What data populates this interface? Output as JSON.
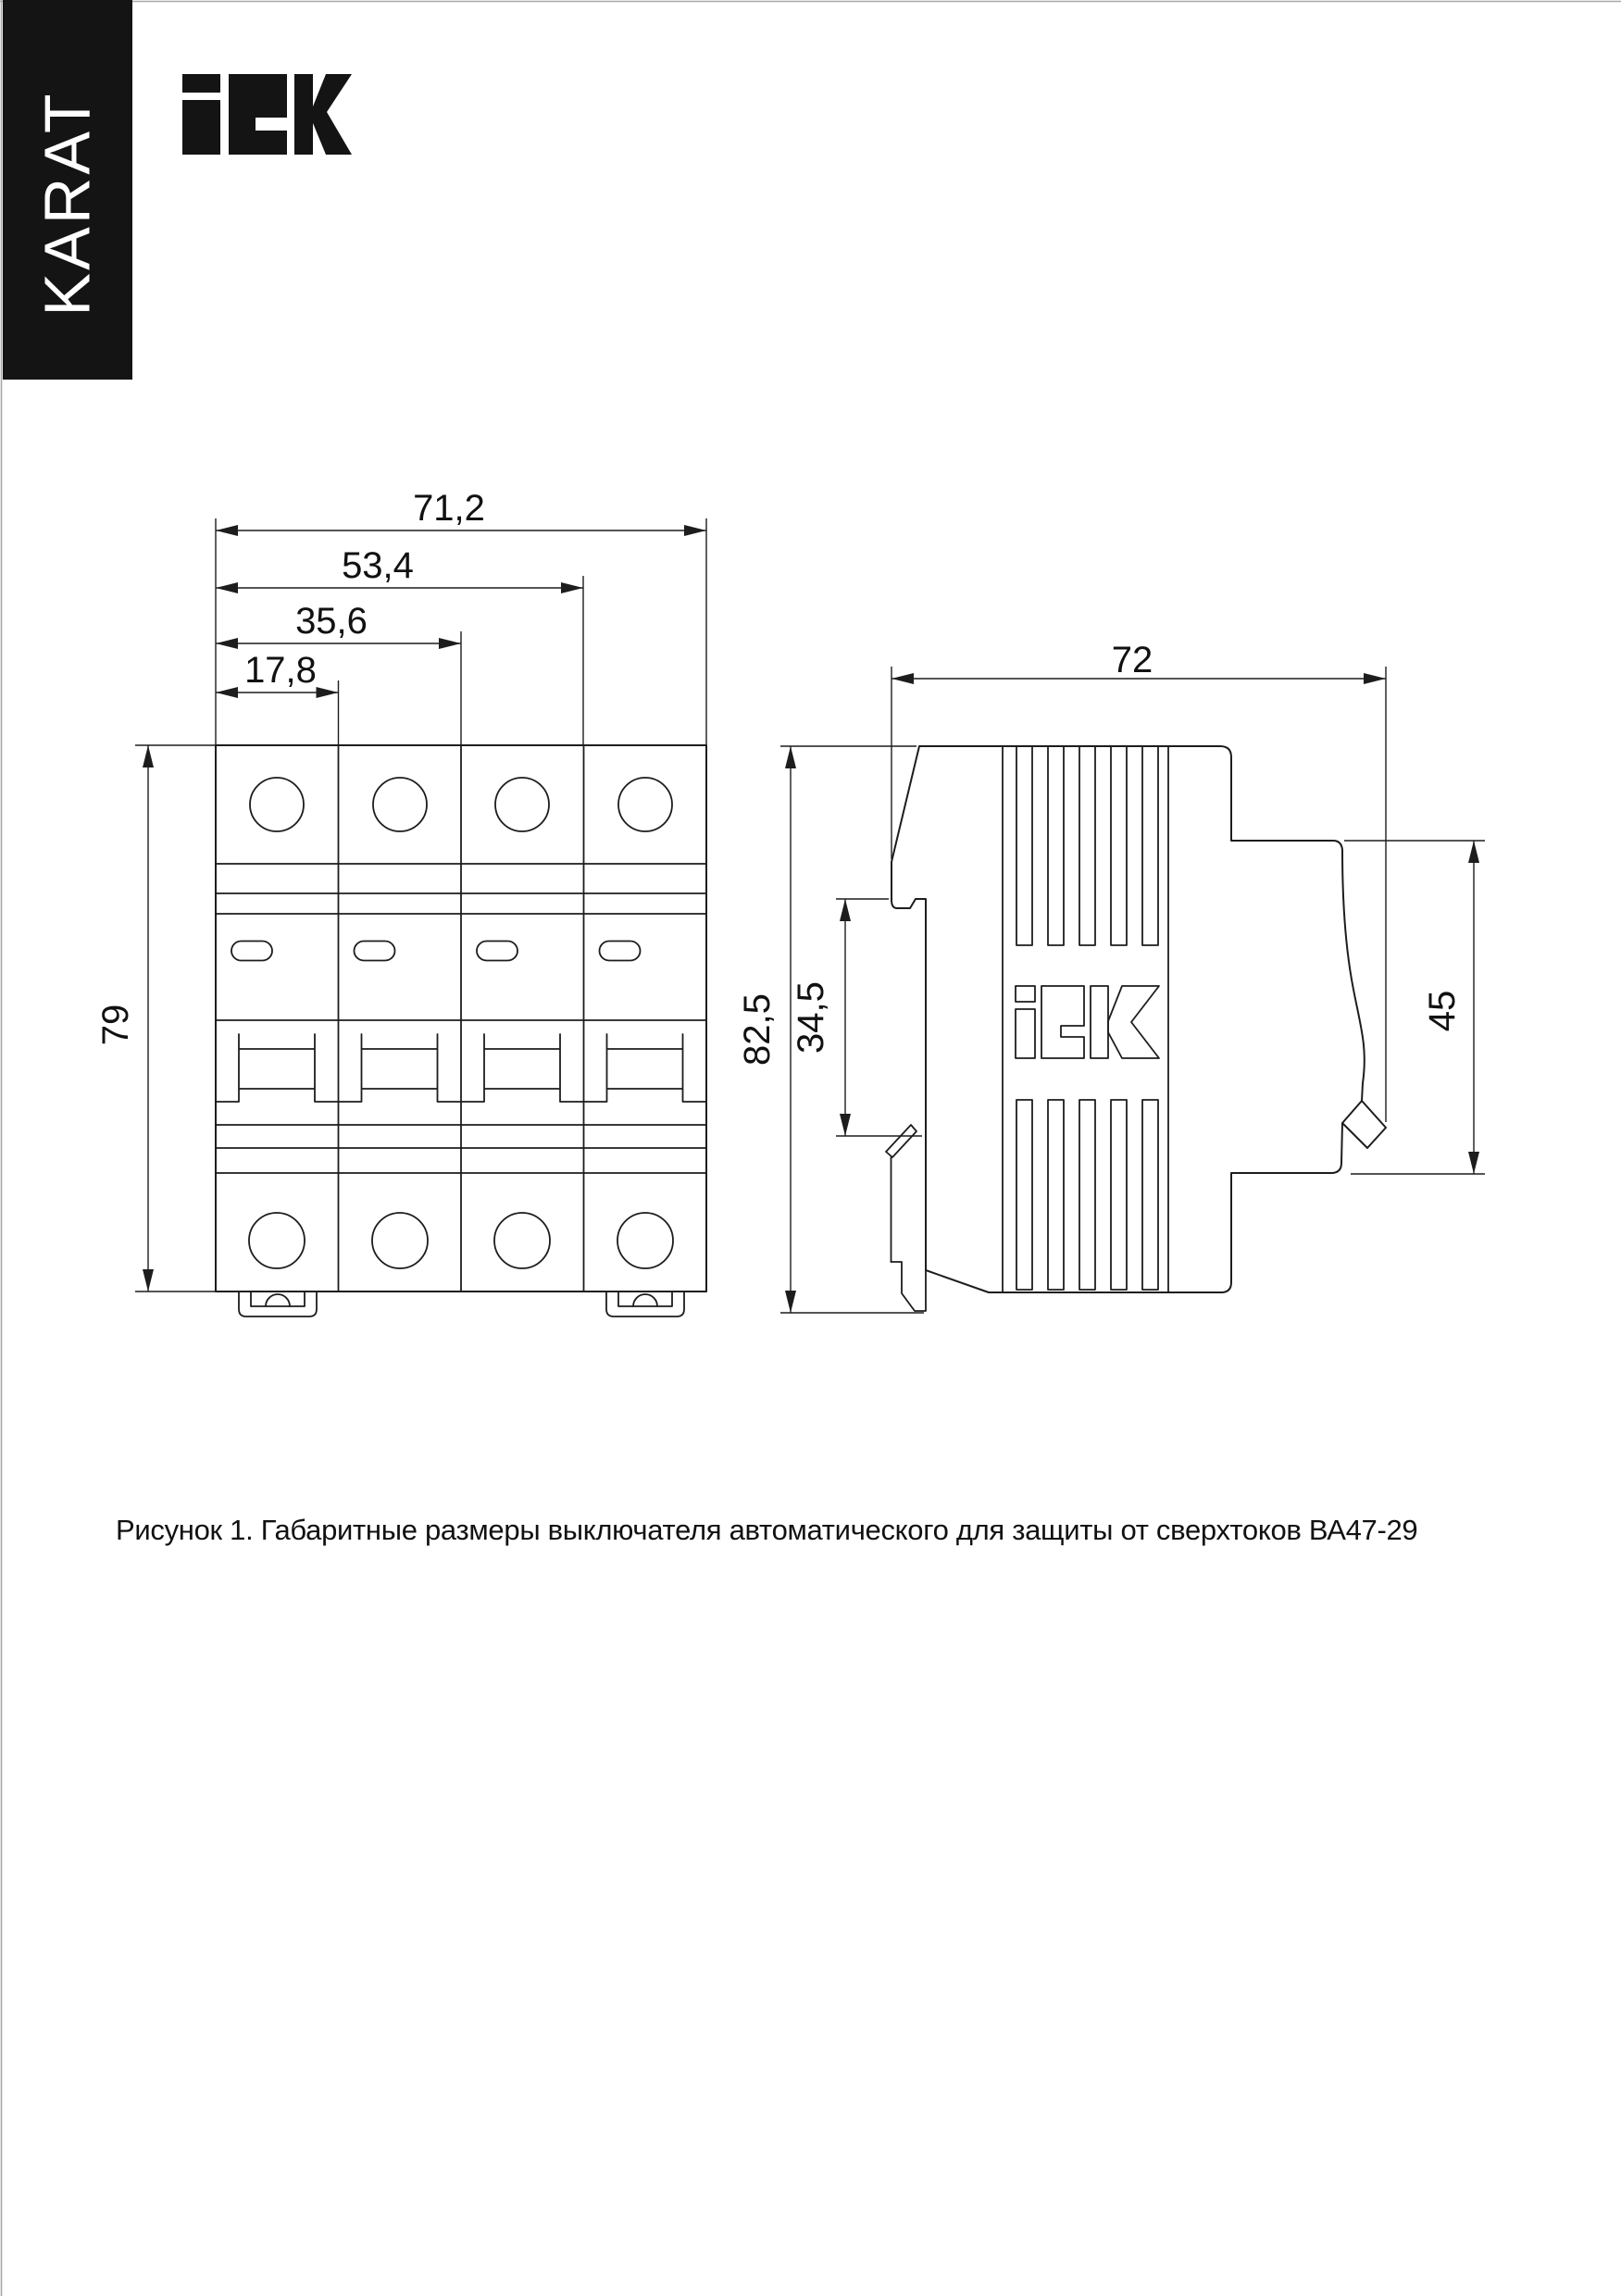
{
  "page": {
    "background": "#ffffff",
    "border_color": "#a8a8a8"
  },
  "banner": {
    "text": "KARAT",
    "bg_color": "#141414",
    "text_color": "#ffffff"
  },
  "brand": {
    "name": "IEK",
    "logo_text": "iEK",
    "color": "#141414"
  },
  "figure": {
    "caption": "Рисунок 1. Габаритные размеры выключателя автоматического для защиты от сверхтоков ВА47-29",
    "product": "ВА47-29",
    "front_view": {
      "name": "front-view-4-pole-breaker",
      "poles": 4,
      "dims": {
        "width_total": "71,2",
        "width_three_modules": "53,4",
        "width_two_modules": "35,6",
        "width_one_module": "17,8",
        "height": "79"
      }
    },
    "side_view": {
      "name": "side-view-breaker",
      "emboss_logo": "iEK",
      "dims": {
        "depth": "72",
        "height": "82,5",
        "din_recess": "34,5",
        "front_part_height": "45"
      }
    }
  }
}
